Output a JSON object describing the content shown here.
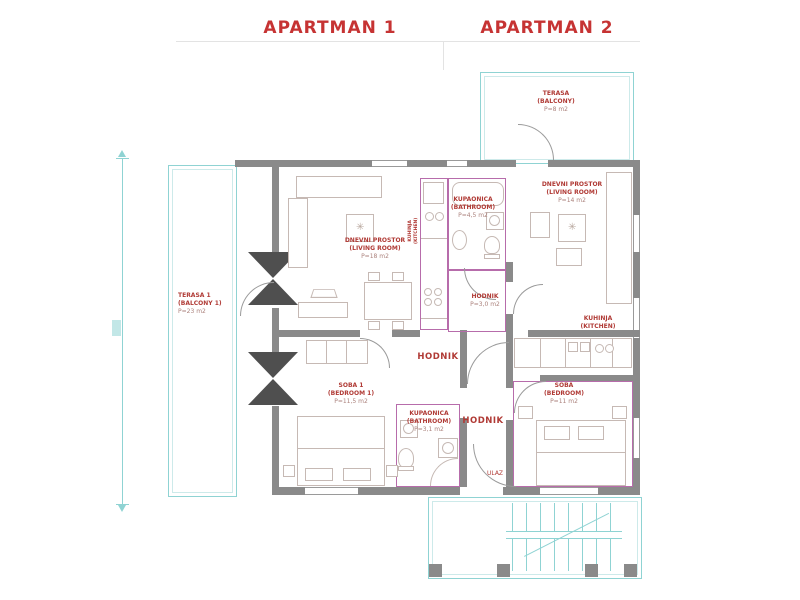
{
  "colors": {
    "title_red": "#c63333",
    "label_red": "#b03a35",
    "area_muted": "#ab827c",
    "wall": "#8a8a8a",
    "cyan": "#8fd3d3",
    "magenta": "#b76cab",
    "furniture": "#c6b9b4"
  },
  "titles": {
    "apartment1": "APARTMAN 1",
    "apartment2": "APARTMAN 2"
  },
  "labels": {
    "terasa_top": {
      "l1": "TERASA",
      "l2": "(BALCONY)",
      "l3": "P=8 m2"
    },
    "terasa1": {
      "l1": "TERASA 1",
      "l2": "(BALCONY 1)",
      "l3": "P=23 m2"
    },
    "dnevni1": {
      "l1": "DNEVNI PROSTOR",
      "l2": "(LIVING ROOM)",
      "l3": "P=18 m2"
    },
    "kuhinja1": {
      "l1": "KUHINJA",
      "l2": "(KITCHEN)"
    },
    "kupaonica1": {
      "l1": "KUPAONICA",
      "l2": "(BATHROOM)",
      "l3": "P=4,5 m2"
    },
    "dnevni2": {
      "l1": "DNEVNI PROSTOR",
      "l2": "(LIVING ROOM)",
      "l3": "P=14 m2"
    },
    "hodnik2": {
      "l1": "HODNIK",
      "l3": "P=3,0 m2"
    },
    "kuhinja2": {
      "l1": "KUHINJA",
      "l2": "(KITCHEN)"
    },
    "hodnik1": {
      "l1": "HODNIK"
    },
    "soba1": {
      "l1": "SOBA 1",
      "l2": "(BEDROOM 1)",
      "l3": "P=11,5 m2"
    },
    "kupaonica2": {
      "l1": "KUPAONICA",
      "l2": "(BATHROOM)",
      "l3": "P=3,1 m2"
    },
    "soba2": {
      "l1": "SOBA",
      "l2": "(BEDROOM)",
      "l3": "P=11 m2"
    },
    "hodnik3": {
      "l1": "HODNIK"
    },
    "ulaz": {
      "l1": "ULAZ"
    }
  },
  "icons": {
    "plant": "✳"
  }
}
